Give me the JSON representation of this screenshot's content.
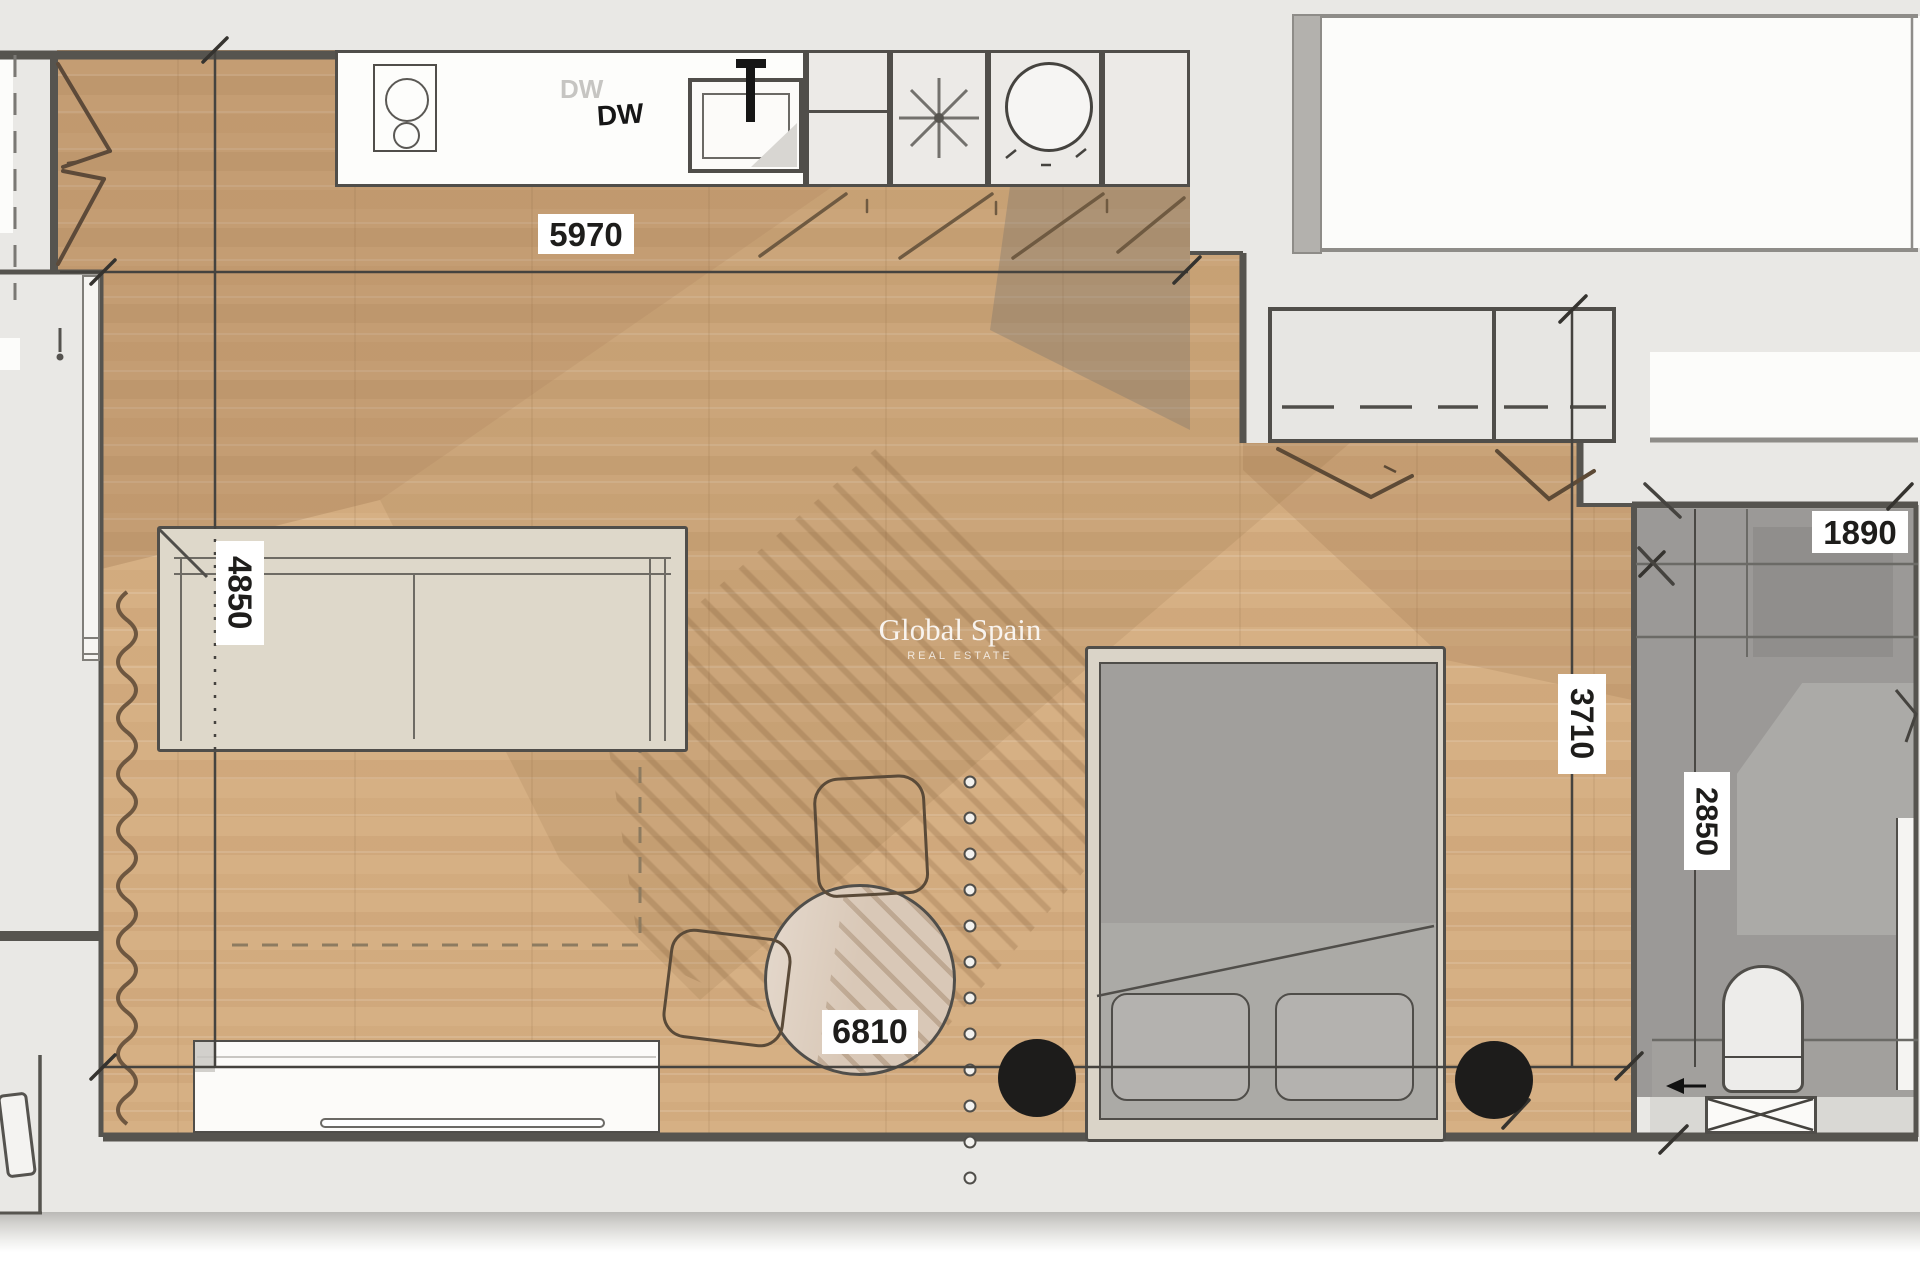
{
  "watermark": {
    "title": "Global Spain",
    "subtitle": "REAL ESTATE"
  },
  "appliances": {
    "dishwasher_faint": "DW",
    "dishwasher": "DW"
  },
  "dimensions": {
    "living_width": "5970",
    "living_depth": "4850",
    "studio_length": "6810",
    "hall_depth": "3710",
    "bathroom_depth": "2850",
    "bathroom_width": "1890"
  },
  "colors": {
    "paper": "#e9e8e5",
    "wood_floor": "#d6b084",
    "wall": "#56544f",
    "bathroom_floor": "#9b9997",
    "pouf_black": "#1d1c1b",
    "label_bg": "#ffffff"
  }
}
